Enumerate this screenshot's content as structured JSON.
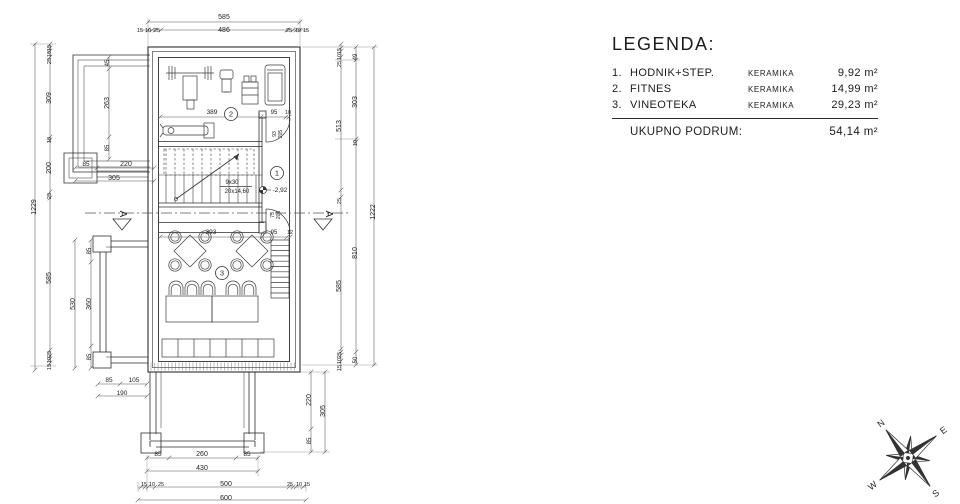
{
  "legend": {
    "title": "LEGENDA:",
    "rows": [
      {
        "num": "1.",
        "name": "HODNIK+STEP.",
        "material": "KERAMIKA",
        "area": "9,92 m²"
      },
      {
        "num": "2.",
        "name": "FITNES",
        "material": "KERAMIKA",
        "area": "14,99 m²"
      },
      {
        "num": "3.",
        "name": "VINEOTEKA",
        "material": "KERAMIKA",
        "area": "29,23 m²"
      }
    ],
    "total_label": "UKUPNO PODRUM:",
    "total_area": "54,14 m²"
  },
  "plan": {
    "room_markers": [
      {
        "n": "1",
        "x": 277,
        "y": 173
      },
      {
        "n": "2",
        "x": 231,
        "y": 114
      },
      {
        "n": "3",
        "x": 222,
        "y": 273
      }
    ],
    "labels": [
      {
        "t": "585",
        "x": 224,
        "y": 19
      },
      {
        "t": "15",
        "x": 140,
        "y": 32,
        "s": 5.5
      },
      {
        "t": "10",
        "x": 148,
        "y": 32,
        "s": 5.5
      },
      {
        "t": "25",
        "x": 157,
        "y": 32,
        "s": 5.5
      },
      {
        "t": "486",
        "x": 224,
        "y": 32
      },
      {
        "t": "25",
        "x": 289,
        "y": 32,
        "s": 5.5
      },
      {
        "t": "10",
        "x": 298,
        "y": 32,
        "s": 5.5
      },
      {
        "t": "15",
        "x": 306,
        "y": 32,
        "s": 5.5
      },
      {
        "t": "1229",
        "x": 36,
        "y": 207,
        "r": -90
      },
      {
        "t": "15",
        "x": 51,
        "y": 48,
        "r": -90,
        "s": 5.5
      },
      {
        "t": "10",
        "x": 51,
        "y": 54,
        "r": -90,
        "s": 5.5
      },
      {
        "t": "25",
        "x": 51,
        "y": 61,
        "r": -90,
        "s": 5.5
      },
      {
        "t": "309",
        "x": 51,
        "y": 98,
        "r": -90
      },
      {
        "t": "10",
        "x": 51,
        "y": 140,
        "r": -90,
        "s": 5.5
      },
      {
        "t": "200",
        "x": 51,
        "y": 168,
        "r": -90
      },
      {
        "t": "25",
        "x": 51,
        "y": 196,
        "r": -90,
        "s": 5.5
      },
      {
        "t": "585",
        "x": 51,
        "y": 278,
        "r": -90
      },
      {
        "t": "25",
        "x": 51,
        "y": 354,
        "r": -90,
        "s": 5.5
      },
      {
        "t": "10",
        "x": 51,
        "y": 360,
        "r": -90,
        "s": 5.5
      },
      {
        "t": "15",
        "x": 51,
        "y": 367,
        "r": -90,
        "s": 5.5
      },
      {
        "t": "45",
        "x": 109,
        "y": 63,
        "r": -90,
        "s": 6
      },
      {
        "t": "263",
        "x": 109,
        "y": 103,
        "r": -90
      },
      {
        "t": "85",
        "x": 109,
        "y": 148,
        "r": -90,
        "s": 6
      },
      {
        "t": "85",
        "x": 86,
        "y": 166,
        "s": 6.5
      },
      {
        "t": "220",
        "x": 126,
        "y": 166
      },
      {
        "t": "305",
        "x": 114,
        "y": 180
      },
      {
        "t": "85",
        "x": 91,
        "y": 251,
        "r": -90,
        "s": 6
      },
      {
        "t": "360",
        "x": 91,
        "y": 304,
        "r": -90
      },
      {
        "t": "85",
        "x": 91,
        "y": 357,
        "r": -90,
        "s": 6
      },
      {
        "t": "530",
        "x": 75,
        "y": 304,
        "r": -90
      },
      {
        "t": "85",
        "x": 109,
        "y": 382,
        "s": 6.5
      },
      {
        "t": "105",
        "x": 134,
        "y": 382,
        "s": 6.5
      },
      {
        "t": "190",
        "x": 122,
        "y": 395,
        "s": 6.5
      },
      {
        "t": "85",
        "x": 158,
        "y": 456,
        "s": 6.5
      },
      {
        "t": "260",
        "x": 202,
        "y": 456
      },
      {
        "t": "85",
        "x": 247,
        "y": 456,
        "s": 6.5
      },
      {
        "t": "430",
        "x": 202,
        "y": 470
      },
      {
        "t": "15",
        "x": 144,
        "y": 486,
        "s": 5.5
      },
      {
        "t": "10",
        "x": 152,
        "y": 486,
        "s": 5.5
      },
      {
        "t": "25",
        "x": 161,
        "y": 486,
        "s": 5.5
      },
      {
        "t": "500",
        "x": 226,
        "y": 486
      },
      {
        "t": "25",
        "x": 290,
        "y": 486,
        "s": 5.5
      },
      {
        "t": "10",
        "x": 299,
        "y": 486,
        "s": 5.5
      },
      {
        "t": "15",
        "x": 307,
        "y": 486,
        "s": 5.5
      },
      {
        "t": "600",
        "x": 226,
        "y": 500
      },
      {
        "t": "220",
        "x": 311,
        "y": 400,
        "r": -90
      },
      {
        "t": "305",
        "x": 325,
        "y": 411,
        "r": -90
      },
      {
        "t": "85",
        "x": 311,
        "y": 441,
        "r": -90,
        "s": 6
      },
      {
        "t": "15",
        "x": 341,
        "y": 51,
        "r": -90,
        "s": 5.5
      },
      {
        "t": "10",
        "x": 341,
        "y": 57,
        "r": -90,
        "s": 5.5
      },
      {
        "t": "25",
        "x": 341,
        "y": 64,
        "r": -90,
        "s": 5.5
      },
      {
        "t": "513",
        "x": 341,
        "y": 126,
        "r": -90
      },
      {
        "t": "25",
        "x": 341,
        "y": 201,
        "r": -90,
        "s": 5.5
      },
      {
        "t": "585",
        "x": 341,
        "y": 286,
        "r": -90
      },
      {
        "t": "25",
        "x": 341,
        "y": 355,
        "r": -90,
        "s": 5.5
      },
      {
        "t": "10",
        "x": 341,
        "y": 361,
        "r": -90,
        "s": 5.5
      },
      {
        "t": "15",
        "x": 341,
        "y": 368,
        "r": -90,
        "s": 5.5
      },
      {
        "t": "49",
        "x": 357,
        "y": 57,
        "r": -90,
        "s": 6
      },
      {
        "t": "303",
        "x": 357,
        "y": 102,
        "r": -90
      },
      {
        "t": "10",
        "x": 357,
        "y": 143,
        "r": -90,
        "s": 5.5
      },
      {
        "t": "810",
        "x": 357,
        "y": 253,
        "r": -90
      },
      {
        "t": "50",
        "x": 357,
        "y": 360,
        "r": -90,
        "s": 6
      },
      {
        "t": "1222",
        "x": 375,
        "y": 212,
        "r": -90
      },
      {
        "t": "389",
        "x": 212,
        "y": 114,
        "s": 6.5
      },
      {
        "t": "95",
        "x": 274,
        "y": 114,
        "s": 6
      },
      {
        "t": "10",
        "x": 288,
        "y": 114,
        "s": 5.5
      },
      {
        "t": "393",
        "x": 211,
        "y": 234,
        "s": 6.5
      },
      {
        "t": "95",
        "x": 274,
        "y": 234,
        "s": 6
      },
      {
        "t": "12",
        "x": 290,
        "y": 234,
        "s": 5.5
      },
      {
        "t": "9x30",
        "x": 232,
        "y": 184,
        "s": 6
      },
      {
        "t": "20x14,60",
        "x": 237,
        "y": 193,
        "s": 6
      },
      {
        "t": "-2,92",
        "x": 280,
        "y": 192,
        "s": 6.5
      },
      {
        "t": "93",
        "x": 276,
        "y": 134,
        "r": -90,
        "s": 5
      },
      {
        "t": "205",
        "x": 282,
        "y": 134,
        "r": -90,
        "s": 5
      },
      {
        "t": "75",
        "x": 274,
        "y": 215,
        "r": -90,
        "s": 5
      },
      {
        "t": "205",
        "x": 280,
        "y": 215,
        "r": -90,
        "s": 5
      },
      {
        "t": "A",
        "x": 120,
        "y": 214,
        "r": 90,
        "s": 10
      },
      {
        "t": "A",
        "x": 326,
        "y": 214,
        "r": 90,
        "s": 10
      }
    ]
  },
  "compass": {
    "n": "N",
    "e": "E",
    "s": "S",
    "w": "W"
  }
}
